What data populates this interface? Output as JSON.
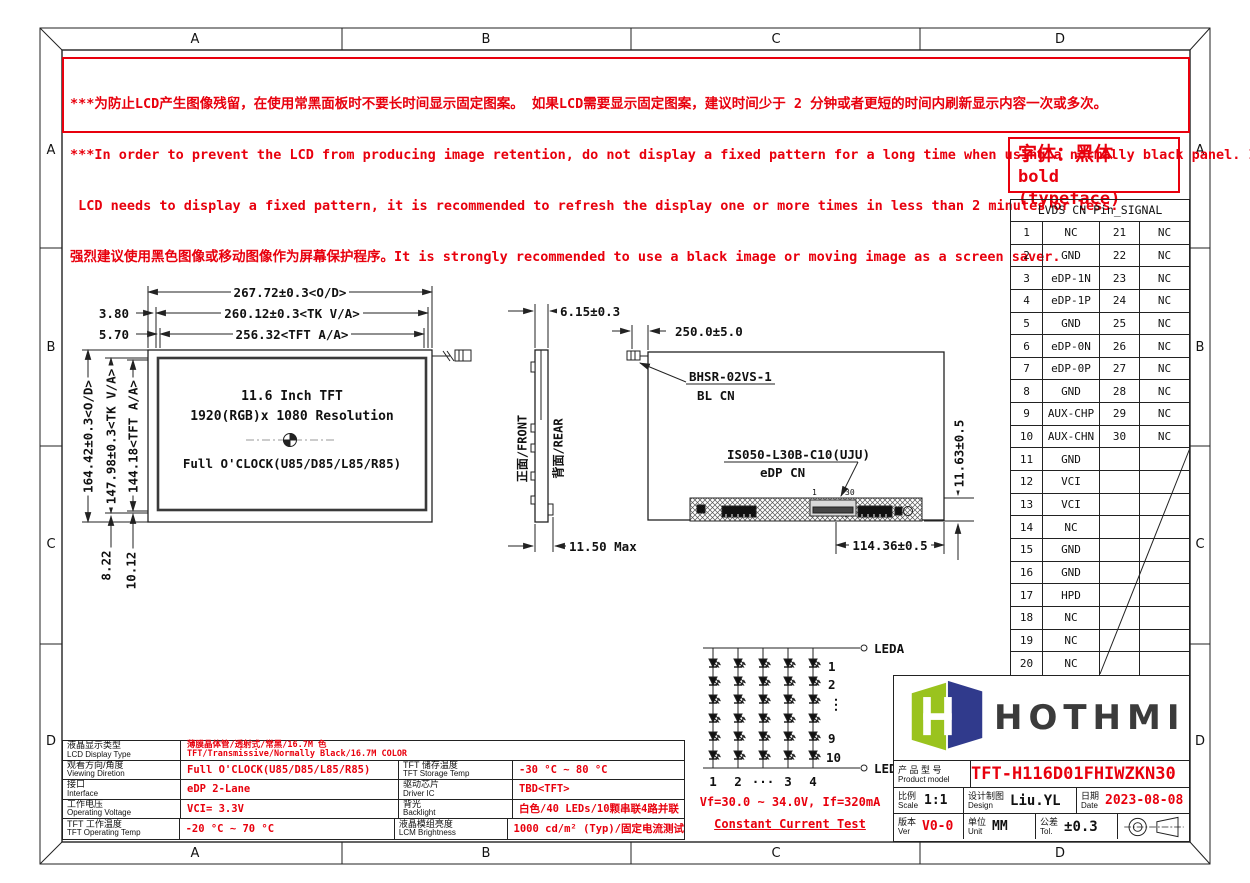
{
  "border": {
    "cols": [
      "A",
      "B",
      "C",
      "D"
    ],
    "rows": [
      "A",
      "B",
      "C",
      "D"
    ]
  },
  "warning": {
    "line1": "***为防止LCD产生图像残留，在使用常黑面板时不要长时间显示固定图案。 如果LCD需要显示固定图案，建议时间少于 2 分钟或者更短的时间内刷新显示内容一次或多次。",
    "line2": "***In order to prevent the LCD from producing image retention, do not display a fixed pattern for a long time when using a normally black panel. If the",
    "line3": " LCD needs to display a fixed pattern, it is recommended to refresh the display one or more times in less than 2 minutes or less.",
    "line4": "强烈建议使用黑色图像或移动图像作为屏幕保护程序。It is strongly recommended to use a black image or moving image as a screen saver."
  },
  "font_note": {
    "line1": "字体：黑体",
    "line2": "bold (typeface)"
  },
  "pin_table": {
    "title": "LVDS CN Pin_SIGNAL",
    "rows": [
      {
        "p1": "1",
        "s1": "NC",
        "p2": "21",
        "s2": "NC"
      },
      {
        "p1": "2",
        "s1": "GND",
        "p2": "22",
        "s2": "NC"
      },
      {
        "p1": "3",
        "s1": "eDP-1N",
        "p2": "23",
        "s2": "NC"
      },
      {
        "p1": "4",
        "s1": "eDP-1P",
        "p2": "24",
        "s2": "NC"
      },
      {
        "p1": "5",
        "s1": "GND",
        "p2": "25",
        "s2": "NC"
      },
      {
        "p1": "6",
        "s1": "eDP-0N",
        "p2": "26",
        "s2": "NC"
      },
      {
        "p1": "7",
        "s1": "eDP-0P",
        "p2": "27",
        "s2": "NC"
      },
      {
        "p1": "8",
        "s1": "GND",
        "p2": "28",
        "s2": "NC"
      },
      {
        "p1": "9",
        "s1": "AUX-CHP",
        "p2": "29",
        "s2": "NC"
      },
      {
        "p1": "10",
        "s1": "AUX-CHN",
        "p2": "30",
        "s2": "NC"
      },
      {
        "p1": "11",
        "s1": "GND",
        "p2": "",
        "s2": ""
      },
      {
        "p1": "12",
        "s1": "VCI",
        "p2": "",
        "s2": ""
      },
      {
        "p1": "13",
        "s1": "VCI",
        "p2": "",
        "s2": ""
      },
      {
        "p1": "14",
        "s1": "NC",
        "p2": "",
        "s2": ""
      },
      {
        "p1": "15",
        "s1": "GND",
        "p2": "",
        "s2": ""
      },
      {
        "p1": "16",
        "s1": "GND",
        "p2": "",
        "s2": ""
      },
      {
        "p1": "17",
        "s1": "HPD",
        "p2": "",
        "s2": ""
      },
      {
        "p1": "18",
        "s1": "NC",
        "p2": "",
        "s2": ""
      },
      {
        "p1": "19",
        "s1": "NC",
        "p2": "",
        "s2": ""
      },
      {
        "p1": "20",
        "s1": "NC",
        "p2": "",
        "s2": ""
      }
    ]
  },
  "front_view": {
    "dim_od_w": "267.72±0.3<O/D>",
    "dim_tk_w": "260.12±0.3<TK V/A>",
    "dim_aa_w": "256.32<TFT A/A>",
    "off1": "3.80",
    "off2": "5.70",
    "dim_od_h": "164.42±0.3<O/D>",
    "dim_tk_h": "147.98±0.3<TK V/A>",
    "dim_aa_h": "144.18<TFT A/A>",
    "bot1": "8.22",
    "bot2": "10.12",
    "line1": "11.6 Inch TFT",
    "line2": "1920(RGB)x 1080 Resolution",
    "line3": "Full O'CLOCK(U85/D85/L85/R85)"
  },
  "side_view": {
    "front_label": "正面/FRONT",
    "rear_label": "背面/REAR",
    "thickness": "6.15±0.3",
    "max_thickness": "11.50 Max"
  },
  "rear_view": {
    "dim_top": "250.0±5.0",
    "bl_cn_line1": "BHSR-02VS-1",
    "bl_cn_line2": "BL CN",
    "edp_line1": "IS050-L30B-C10(UJU)",
    "edp_line2": "eDP CN",
    "pin_first": "1",
    "pin_last": "30",
    "dim_right": "11.63±0.5",
    "dim_bottom": "114.36±0.5"
  },
  "led": {
    "leda": "LEDA",
    "ledk": "LEDK",
    "row1": "1",
    "row2": "2",
    "row_dots": "⋮",
    "row5": "9",
    "row6": "10",
    "col1": "1",
    "col2": "2",
    "col_dots": "···",
    "col3": "3",
    "col4": "4",
    "spec": "Vf=30.0 ~ 34.0V, If=320mA",
    "test": "Constant Current Test"
  },
  "spec_table": {
    "row1": {
      "label_cn": "液晶显示类型",
      "label_en": "LCD Display Type",
      "value_cn": "薄膜晶体管/透射式/常黑/16.7M 色",
      "value_en": "TFT/Transmissive/Normally Black/16.7M COLOR"
    },
    "left_rows": [
      {
        "cn": "观看方向/角度",
        "en": "Viewing Diretion",
        "val": "Full O'CLOCK(U85/D85/L85/R85)"
      },
      {
        "cn": "接口",
        "en": "Interface",
        "val": "eDP 2-Lane"
      },
      {
        "cn": "工作电压",
        "en": "Operating Voltage",
        "val": "VCI= 3.3V"
      },
      {
        "cn": "TFT 工作温度",
        "en": "TFT Operating Temp",
        "val": "-20 °C ~ 70 °C"
      }
    ],
    "right_rows": [
      {
        "cn": "TFT 储存温度",
        "en": "TFT Storage Temp",
        "val": "-30 °C ~ 80 °C"
      },
      {
        "cn": "驱动芯片",
        "en": "Driver IC",
        "val": "TBD<TFT>"
      },
      {
        "cn": "背光",
        "en": "Backlight",
        "val": "白色/40 LEDs/10颗串联4路并联"
      },
      {
        "cn": "液晶模组亮度",
        "en": "LCM Brightness",
        "val": "1000 cd/m² (Typ)/固定电流测试"
      }
    ]
  },
  "title_block": {
    "brand": "HOTHMI",
    "product_label_cn": "产 品 型 号",
    "product_label_en": "Product model",
    "product_model": "TFT-H116D01FHIWZKN30",
    "scale_cn": "比例",
    "scale_en": "Scale",
    "scale_val": "1:1",
    "design_cn": "设计制图",
    "design_en": "Design",
    "design_val": "Liu.YL",
    "date_cn": "日期",
    "date_en": "Date",
    "date_val": "2023-08-08",
    "ver_cn": "版本",
    "ver_en": "Ver",
    "ver_val": "V0-0",
    "unit_cn": "单位",
    "unit_en": "Unit",
    "unit_val": "MM",
    "tol_cn": "公差",
    "tol_en": "Tol.",
    "tol_val": "±0.3"
  },
  "colors": {
    "red": "#e8000d",
    "logo_green": "#9ac31e",
    "logo_navy": "#303a8c"
  }
}
